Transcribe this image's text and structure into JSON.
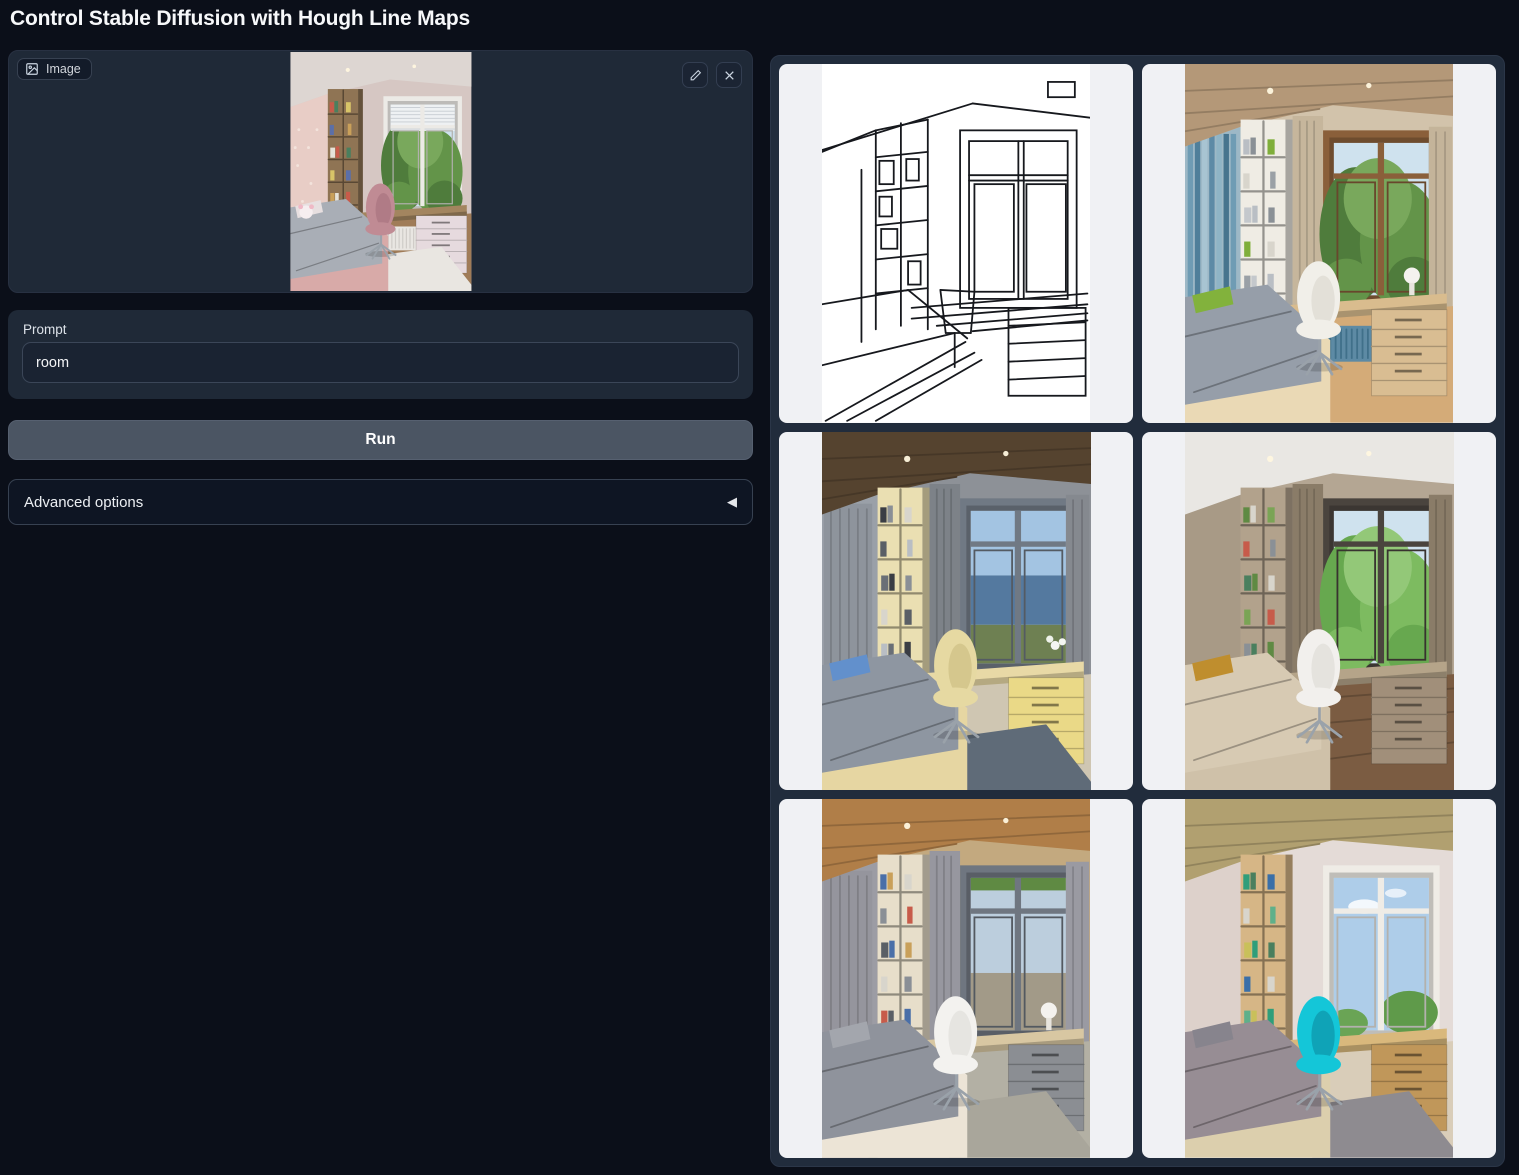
{
  "header": {
    "title": "Control Stable Diffusion with Hough Line Maps"
  },
  "input_image": {
    "label": "Image",
    "icons": {
      "label_icon": "image",
      "edit": "pencil",
      "clear": "x"
    },
    "palette": {
      "ceiling": "#ddd6d2",
      "ceilTex": false,
      "lights": true,
      "wall": "#d6c7c3",
      "leftWall": "#e8cdc6",
      "floral": true,
      "leftStripes": null,
      "leftCurtain": null,
      "shelf": "#8f7454",
      "books": [
        "#c75b4a",
        "#4a7f5e",
        "#d8c468",
        "#5b6fa8",
        "#c9a05a",
        "#e6e2d8"
      ],
      "curtain": null,
      "curtainR": null,
      "winFrame": "#eceae6",
      "view": "trees",
      "blinds": true,
      "desk": "#a3855f",
      "drawer": "#e6dade",
      "radiator": "#e9e6e2",
      "radStripe": "#cfccc8",
      "floor": "#a07c58",
      "plank": false,
      "rug": "#e9e6e1",
      "bedFrame": "#d8aaa8",
      "bed": "#a9aeb6",
      "pillow": "#e7dfe0",
      "chair": "#c08b94",
      "chairDark": "#a06b78",
      "plush": true,
      "lamp": false,
      "flowers": false
    }
  },
  "prompt": {
    "label": "Prompt",
    "value": "room"
  },
  "run_button": {
    "label": "Run"
  },
  "advanced": {
    "label": "Advanced options",
    "collapse_icon": "◀"
  },
  "gallery": {
    "items": [
      {
        "name": "hough-line-map",
        "type": "lines",
        "stroke": "#16181d",
        "background": "#ffffff"
      },
      {
        "name": "generated-room-1",
        "type": "photo",
        "palette": {
          "ceiling": "#b49878",
          "ceilTex": true,
          "lights": true,
          "wall": "#d2c3ab",
          "leftWall": "#9db8c6",
          "floral": false,
          "leftStripes": [
            "#6f9cb4",
            "#4f7f9a",
            "#a8c4d2",
            "#5d8aa6",
            "#8fb4c6",
            "#47748e"
          ],
          "leftCurtain": null,
          "shelf": "#efece4",
          "books": [
            "#b9bec4",
            "#8a9096",
            "#7fae3a",
            "#d8d5cc",
            "#9aa0a6",
            "#c4c8cc"
          ],
          "curtain": "#c6b69c",
          "curtainR": "#c4b49a",
          "winFrame": "#8a5f3a",
          "view": "trees",
          "blinds": false,
          "desk": "#d9bc8e",
          "drawer": "#d9bd92",
          "radiator": "#5d8aa4",
          "radStripe": "#40708a",
          "floor": "#d4ab78",
          "plank": false,
          "rug": null,
          "bedFrame": "#ead9b5",
          "bed": "#969ea9",
          "pillow": "#82b23c",
          "chair": "#f1efe9",
          "chairDark": "#d5d2c8",
          "plush": false,
          "lamp": true,
          "flowers": false
        }
      },
      {
        "name": "generated-room-2",
        "type": "photo",
        "palette": {
          "ceiling": "#55432f",
          "ceilTex": true,
          "lights": true,
          "wall": "#8d9197",
          "leftWall": "#9aa0a8",
          "floral": false,
          "leftStripes": null,
          "leftCurtain": "#8e949c",
          "shelf": "#eadfb2",
          "books": [
            "#3a3d44",
            "#8a8f96",
            "#d8d5cc",
            "#5a5f66",
            "#b9bec4",
            "#6a6f76"
          ],
          "curtain": "#7d8288",
          "curtainR": "#85898f",
          "winFrame": "#707984",
          "view": "sea",
          "blinds": false,
          "desk": "#e8d9a6",
          "drawer": "#ead987",
          "radiator": null,
          "radStripe": null,
          "floor": "#cfc6b2",
          "plank": false,
          "rug": "#5f6b78",
          "bedFrame": "#e6d6a2",
          "bed": "#8e96a1",
          "pillow": "#6290cc",
          "chair": "#e6d9a2",
          "chairDark": "#c4b578",
          "plush": false,
          "lamp": false,
          "flowers": true
        }
      },
      {
        "name": "generated-room-3",
        "type": "photo",
        "palette": {
          "ceiling": "#e9e7e3",
          "ceilTex": false,
          "lights": true,
          "wall": "#b4a693",
          "leftWall": "#a89a86",
          "floral": false,
          "leftStripes": null,
          "leftCurtain": null,
          "shelf": "#b2a28c",
          "books": [
            "#5f8a43",
            "#d8d5cc",
            "#7aa455",
            "#c75b4a",
            "#8a9096",
            "#4a7f5e"
          ],
          "curtain": "#8a7c68",
          "curtainR": "#8a7c68",
          "winFrame": "#4a443e",
          "view": "trees2",
          "blinds": false,
          "desk": "#b5a489",
          "drawer": "#a18f7a",
          "radiator": null,
          "radStripe": null,
          "floor": "#7b5c42",
          "plank": true,
          "rug": null,
          "bedFrame": "#cfc1a9",
          "bed": "#d7cab3",
          "pillow": "#bf8e2e",
          "chair": "#f2f0ed",
          "chairDark": "#d8d5d0",
          "plush": false,
          "lamp": false,
          "flowers": false
        }
      },
      {
        "name": "generated-room-4",
        "type": "photo",
        "palette": {
          "ceiling": "#b07e48",
          "ceilTex": true,
          "lights": true,
          "wall": "#c3a97f",
          "leftWall": "#9c9ca4",
          "floral": false,
          "leftStripes": null,
          "leftCurtain": "#95959d",
          "shelf": "#e7deca",
          "books": [
            "#4a6fa8",
            "#c9a05a",
            "#d8d5cc",
            "#8a8f96",
            "#c75b4a",
            "#5a5f66"
          ],
          "curtain": "#97979f",
          "curtainR": "#9a9aa2",
          "winFrame": "#6f7680",
          "view": "field",
          "blinds": false,
          "desk": "#d8c7a2",
          "drawer": "#8b8e93",
          "radiator": null,
          "radStripe": null,
          "floor": "#b3b0a4",
          "plank": false,
          "rug": "#a9a69b",
          "bedFrame": "#ece4d6",
          "bed": "#8f939c",
          "pillow": "#a3a6ad",
          "chair": "#f3f2ef",
          "chairDark": "#d9d8d4",
          "plush": false,
          "lamp": true,
          "flowers": false
        }
      },
      {
        "name": "generated-room-5",
        "type": "photo",
        "palette": {
          "ceiling": "#b1a070",
          "ceilTex": true,
          "lights": false,
          "wall": "#e4dbd7",
          "leftWall": "#ddd1cb",
          "floral": false,
          "leftStripes": null,
          "leftCurtain": null,
          "shelf": "#d6b686",
          "books": [
            "#2f9e7a",
            "#4a7f5e",
            "#3a6fa8",
            "#d8d5cc",
            "#5fb08a",
            "#c9c05a"
          ],
          "curtain": null,
          "curtainR": null,
          "winFrame": "#efece6",
          "view": "sky",
          "blinds": false,
          "desk": "#d9b87c",
          "drawer": "#c0975a",
          "radiator": null,
          "radStripe": null,
          "floor": "#d9cdb9",
          "plank": false,
          "rug": "#8e8b90",
          "bedFrame": "#dccfad",
          "bed": "#978d94",
          "pillow": "#87848d",
          "chair": "#14c6d8",
          "chairDark": "#0a7f95",
          "plush": false,
          "lamp": false,
          "flowers": false
        }
      }
    ]
  }
}
